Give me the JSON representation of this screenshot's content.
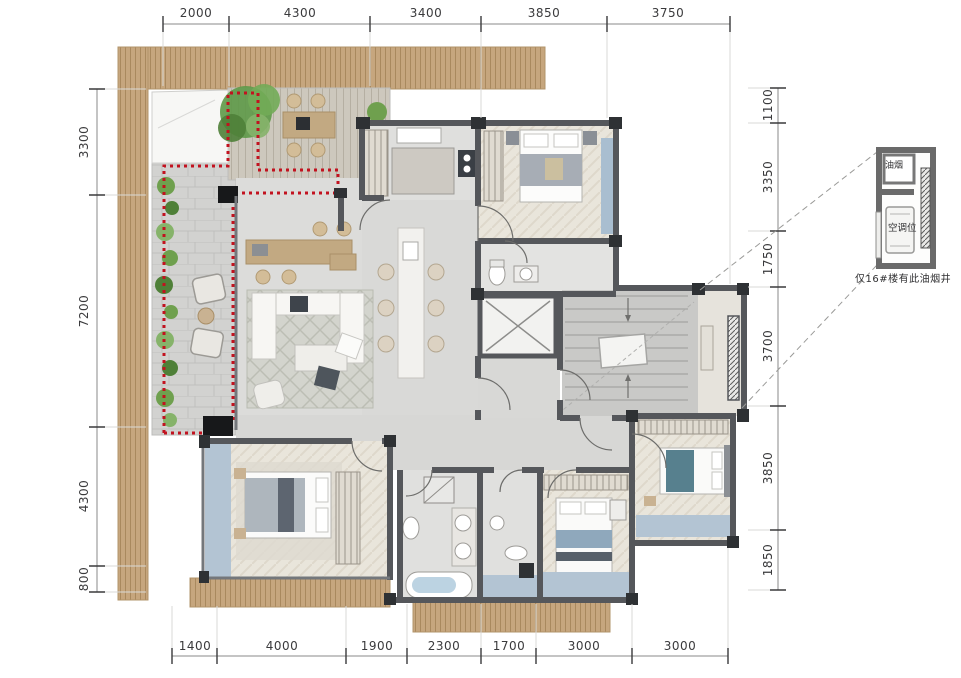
{
  "dimensions": {
    "top": [
      "2000",
      "4300",
      "3400",
      "3850",
      "3750"
    ],
    "bottom": [
      "1400",
      "4000",
      "1900",
      "2300",
      "1700",
      "3000",
      "3000"
    ],
    "left": [
      "3300",
      "7200",
      "4300",
      "800"
    ],
    "right": [
      "1100",
      "3350",
      "1750",
      "3700",
      "3850",
      "1850"
    ]
  },
  "detail_callout": {
    "flue_label": "油烟",
    "ac_label": "空调位",
    "note": "仅16#楼有此油烟井"
  },
  "colors": {
    "wall": "#55575b",
    "wood_slat": "#c6a67e",
    "terrace_boundary_red": "#c2121f",
    "balcony_blue": "#b3c4d3",
    "plant_green": "#6fa04e",
    "floor_gray": "#dcdcda"
  }
}
